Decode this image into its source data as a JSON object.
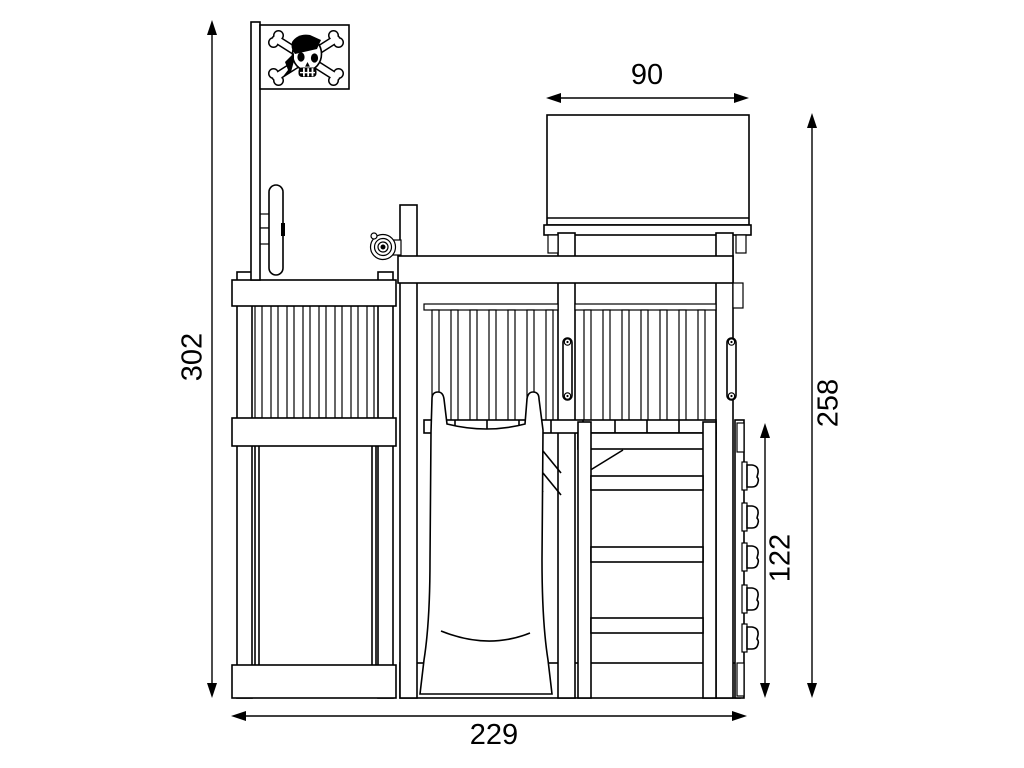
{
  "diagram": {
    "type": "technical-elevation-drawing",
    "style": "black-and-white line art, side view of pirate-themed play tower",
    "dimensions": {
      "total_height": "302",
      "roof_width": "90",
      "rear_height": "258",
      "climbing_wall_height": "122",
      "total_width": "229"
    },
    "colors": {
      "line": "#000000",
      "background": "#ffffff"
    },
    "parts": [
      "pirate-flag",
      "flag-pole",
      "steering-wheel",
      "telescope",
      "roof-box",
      "left-railing-balusters",
      "left-panel",
      "picket-fence",
      "platform-deck",
      "slide",
      "ladder",
      "grab-handles",
      "climbing-holds"
    ]
  }
}
